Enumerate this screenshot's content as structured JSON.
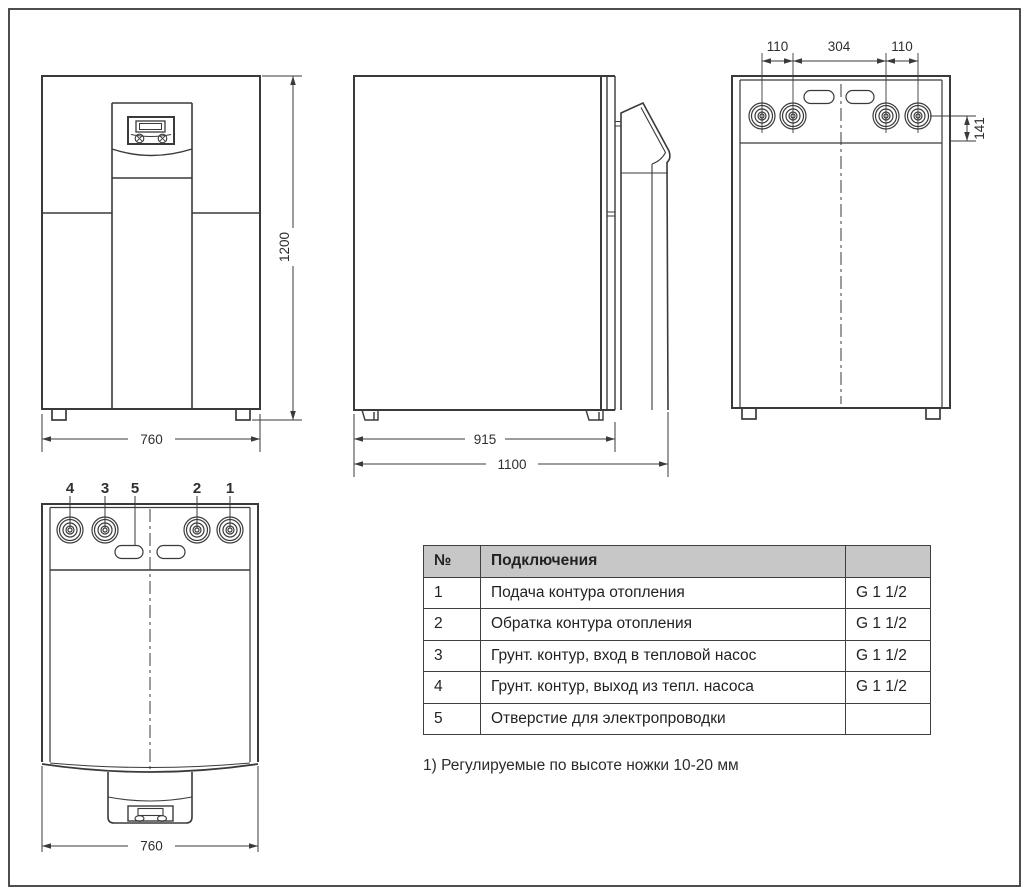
{
  "colors": {
    "line": "#3a3a3a",
    "table_border": "#3f3f3f",
    "table_header_bg": "#c7c7c7",
    "text": "#2b2b2b"
  },
  "views": {
    "front": {
      "width": "760",
      "height": "1200"
    },
    "side": {
      "body_depth": "915",
      "total_depth": "1100"
    },
    "rear": {
      "left_offset": "110",
      "center_span": "304",
      "right_offset": "110",
      "vertical_offset": "141"
    },
    "top": {
      "width": "760",
      "callouts": [
        "4",
        "3",
        "5",
        "2",
        "1"
      ]
    }
  },
  "table": {
    "headers": {
      "num": "№",
      "name": "Подключения",
      "size": ""
    },
    "rows": [
      {
        "num": "1",
        "desc": "Подача контура отопления",
        "size": "G 1 1/2"
      },
      {
        "num": "2",
        "desc": "Обратка контура отопления",
        "size": "G 1 1/2"
      },
      {
        "num": "3",
        "desc": "Грунт. контур, вход в тепловой насос",
        "size": "G 1 1/2"
      },
      {
        "num": "4",
        "desc": "Грунт. контур, выход из тепл. насоса",
        "size": "G 1 1/2"
      },
      {
        "num": "5",
        "desc": "Отверстие для электропроводки",
        "size": ""
      }
    ]
  },
  "footnote": "1) Регулируемые по высоте ножки 10-20 мм"
}
